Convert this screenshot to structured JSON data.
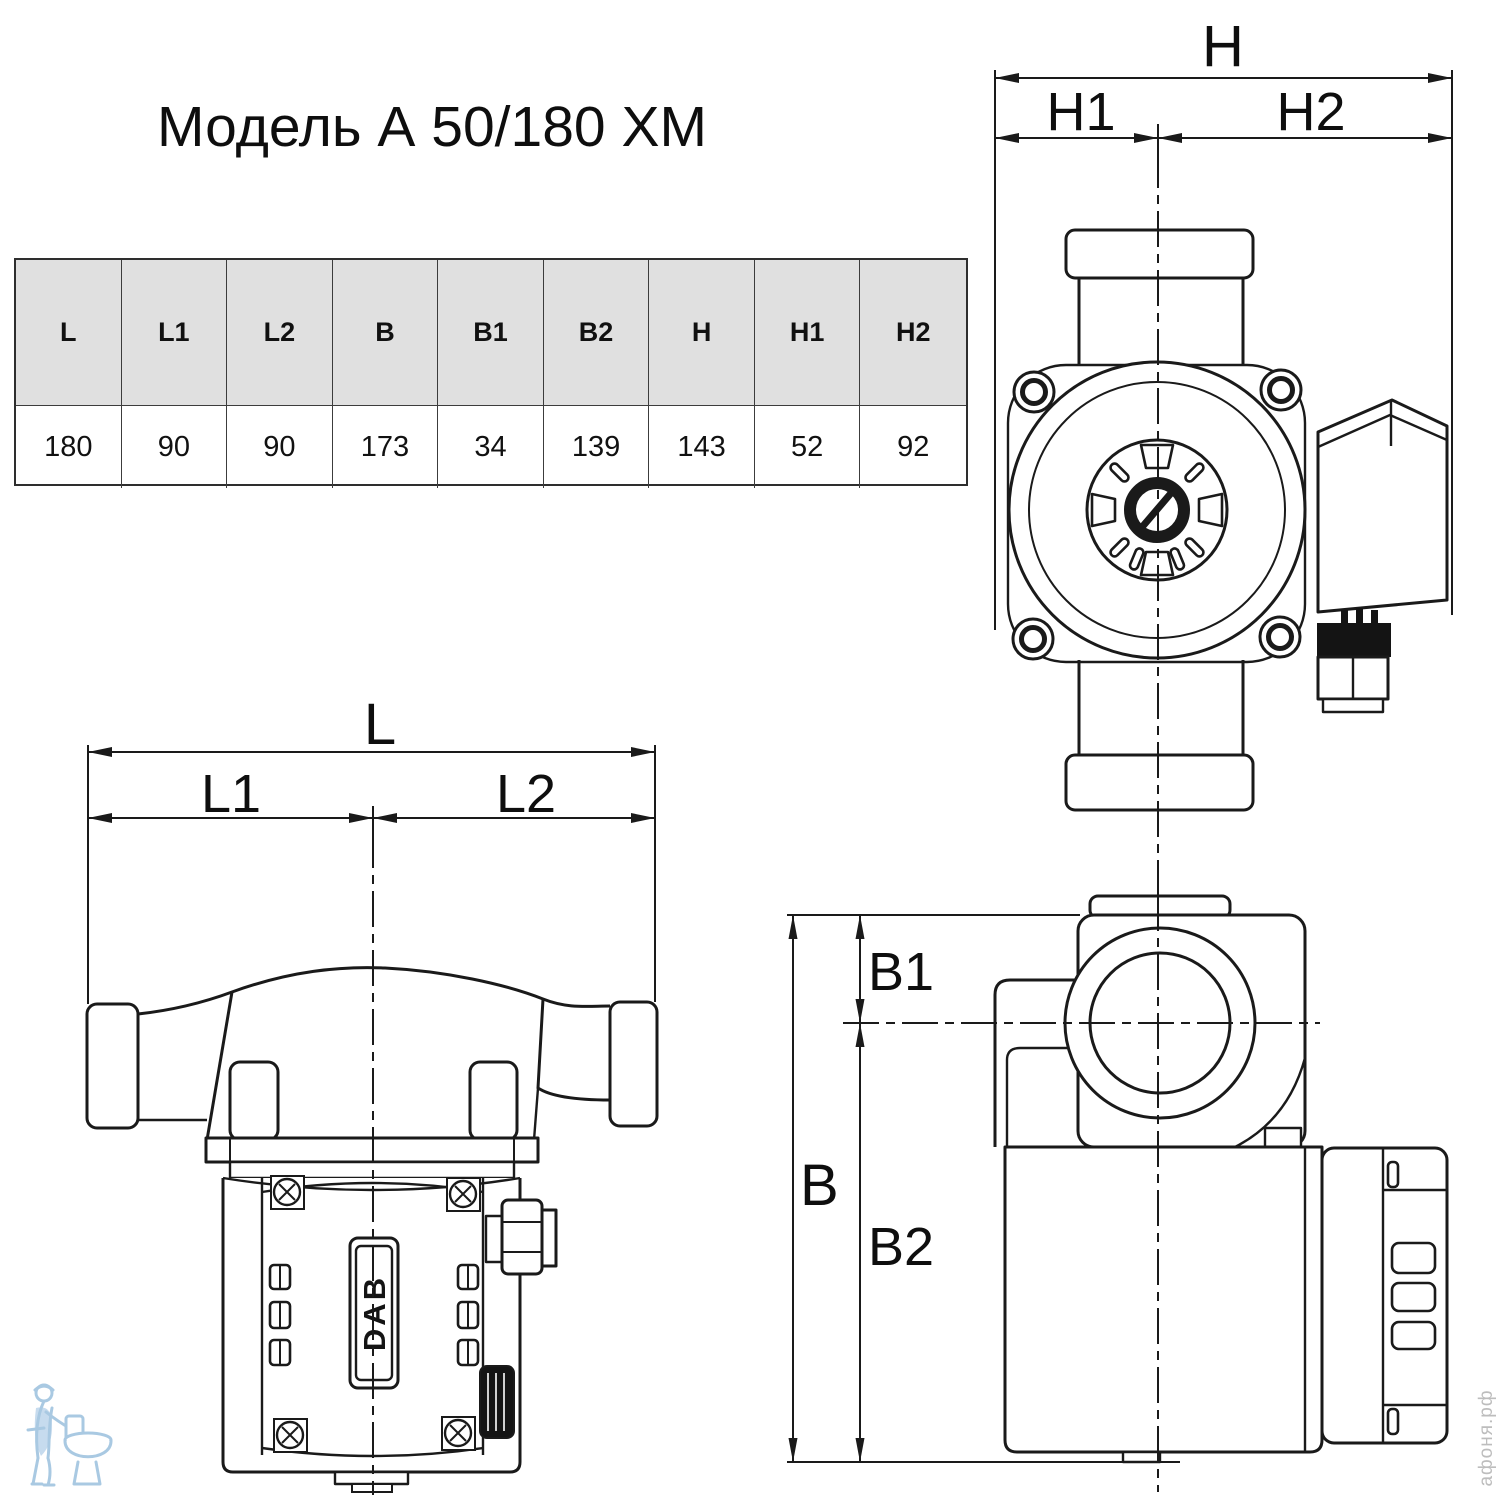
{
  "title": "Модель А 50/180 ХМ",
  "brand_plate": "DAB",
  "watermark_text": "афоня.рф",
  "table": {
    "headers": [
      "L",
      "L1",
      "L2",
      "B",
      "B1",
      "B2",
      "H",
      "H1",
      "H2"
    ],
    "values": [
      "180",
      "90",
      "90",
      "173",
      "34",
      "139",
      "143",
      "52",
      "92"
    ]
  },
  "dimension_labels": {
    "front_view": {
      "total": "H",
      "left": "H1",
      "right": "H2"
    },
    "side_view": {
      "total": "L",
      "left": "L1",
      "right": "L2"
    },
    "back_view": {
      "total": "B",
      "upper": "B1",
      "lower": "B2"
    }
  },
  "colors": {
    "line": "#1a1a1a",
    "table_header_bg": "#e0e0e0",
    "watermark_blue": "#a9c9e2",
    "watermark_gray": "#bdbdbd"
  }
}
